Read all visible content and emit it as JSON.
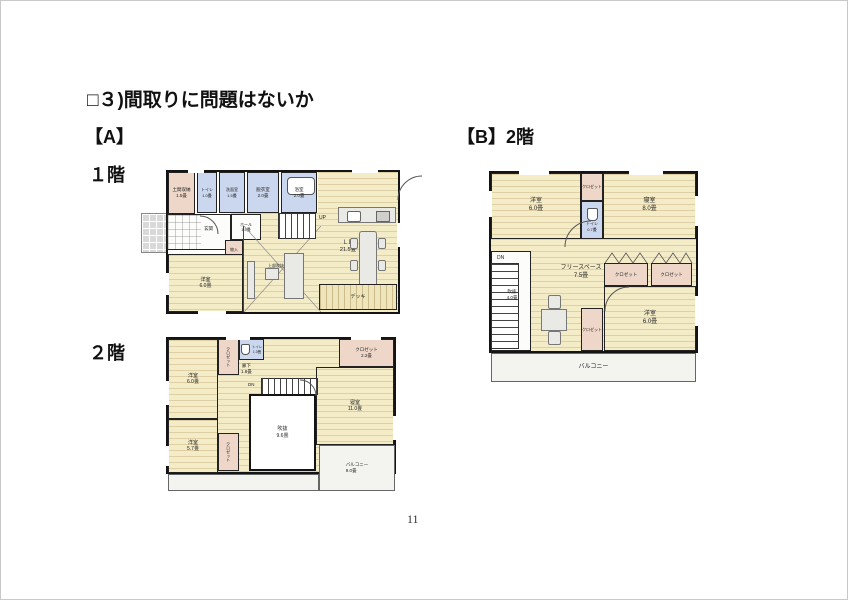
{
  "page": {
    "title": "□３)間取りに問題はないか",
    "page_number": "11"
  },
  "colors": {
    "tatami_cream": "#f4ebc7",
    "closet_pink": "#eed7c8",
    "wet_area_blue": "#cbd7ee",
    "wall_black": "#141414",
    "balcony_gray": "#f3f3f0",
    "porch_gray": "#d9d9d9"
  },
  "plan_a": {
    "label": "【A】",
    "floor1": {
      "label": "１階",
      "rooms": {
        "doma": "土間収納\n1.5畳",
        "toilet": "トイレ\n1.0畳",
        "washroom": "洗面室\n1.5畳",
        "dressing": "脱衣室\n2.0畳",
        "bath": "浴室\n2.0畳",
        "genkan": "玄関",
        "hall": "ホール\n1.5畳",
        "storage": "物入",
        "yoshitsu": "洋室\n6.0畳",
        "atrium_note": "上部吹抜",
        "ld": "ＬＤ\n21.5畳",
        "up": "UP",
        "deck": "デッキ"
      }
    },
    "floor2": {
      "label": "２階",
      "rooms": {
        "yoshitsu1": "洋室\n6.0畳",
        "closet1": "クロゼット",
        "toilet": "トイレ\n1.0畳",
        "hallway": "廊下\n1.8畳",
        "closet22": "クロゼット\n2.2畳",
        "shinshitsu": "寝室\n11.0畳",
        "fukinuke": "吹抜\n9.6畳",
        "dn": "DN",
        "yoshitsu2": "洋室\n5.7畳",
        "closet2": "クロゼット",
        "balcony": "バルコニー\n9.0畳"
      }
    }
  },
  "plan_b": {
    "label": "【B】2階",
    "rooms": {
      "yoshitsu_nw": "洋室\n6.0畳",
      "closet_n": "クロゼット",
      "toilet": "トイレ\n0.7畳",
      "shinshitsu": "寝室\n8.0畳",
      "dn": "DN",
      "fukinuke": "吹抜\n4.0畳",
      "free_space": "フリースペース\n7.5畳",
      "closet_e1": "クロゼット",
      "closet_e2": "クロゼット",
      "closet_s": "クロゼット",
      "yoshitsu_se": "洋室\n6.0畳",
      "balcony": "バルコニー"
    }
  }
}
